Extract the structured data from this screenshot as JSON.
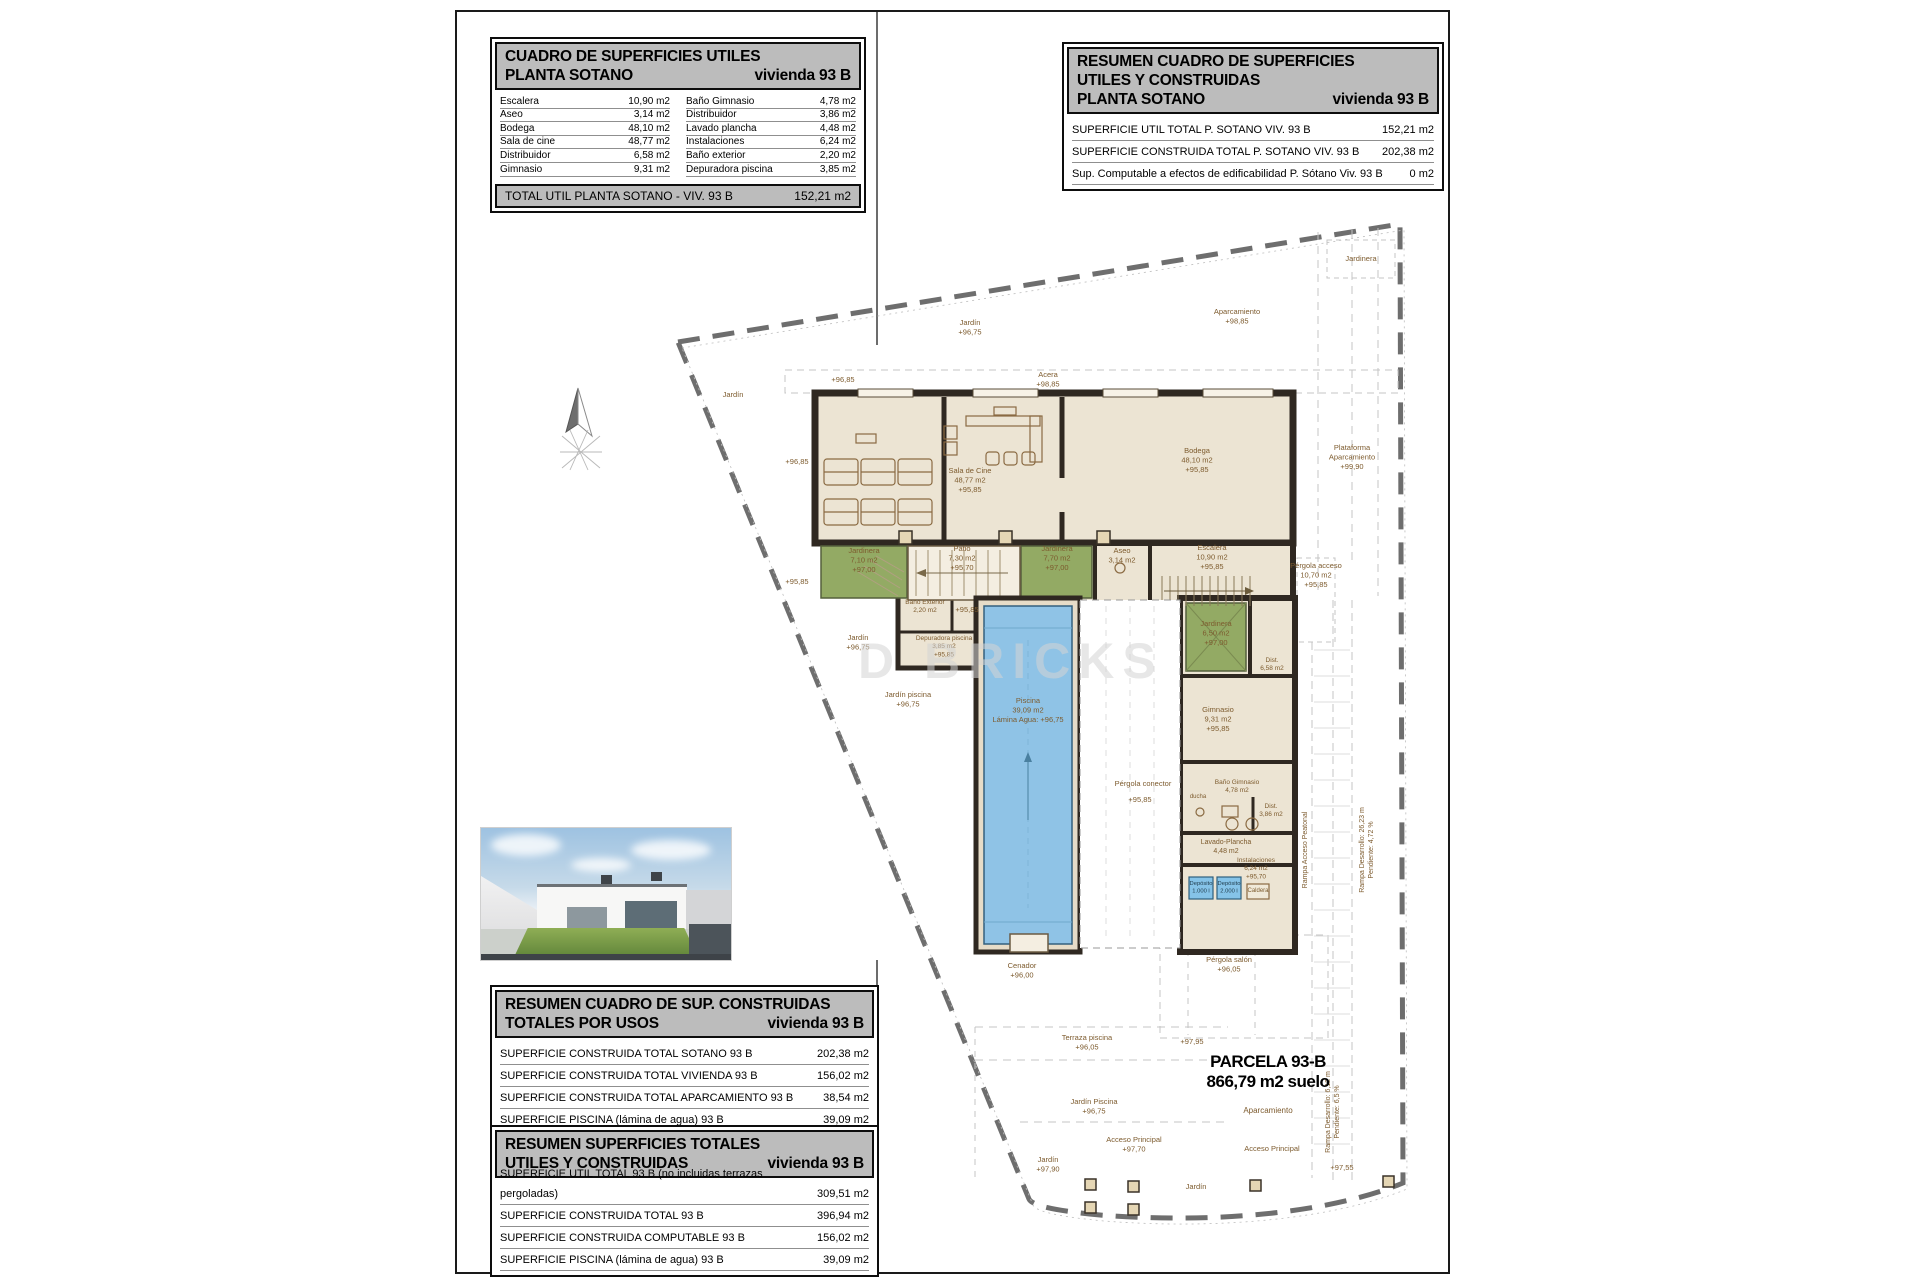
{
  "tables": {
    "cuadro_utiles": {
      "title_line1": "CUADRO DE SUPERFICIES UTILES",
      "title_line2": "PLANTA SOTANO",
      "title_vivienda": "vivienda 93 B",
      "rows_left": [
        {
          "label": "Escalera",
          "value": "10,90 m2"
        },
        {
          "label": "Aseo",
          "value": "3,14 m2"
        },
        {
          "label": "Bodega",
          "value": "48,10 m2"
        },
        {
          "label": "Sala de cine",
          "value": "48,77 m2"
        },
        {
          "label": "Distribuidor",
          "value": "6,58 m2"
        },
        {
          "label": "Gimnasio",
          "value": "9,31 m2"
        }
      ],
      "rows_right": [
        {
          "label": "Baño Gimnasio",
          "value": "4,78 m2"
        },
        {
          "label": "Distribuidor",
          "value": "3,86 m2"
        },
        {
          "label": "Lavado plancha",
          "value": "4,48 m2"
        },
        {
          "label": "Instalaciones",
          "value": "6,24 m2"
        },
        {
          "label": "Baño exterior",
          "value": "2,20 m2"
        },
        {
          "label": "Depuradora piscina",
          "value": "3,85 m2"
        }
      ],
      "total_label": "TOTAL UTIL PLANTA SOTANO -  VIV. 93 B",
      "total_value": "152,21 m2"
    },
    "resumen_sotano": {
      "title_line1": "RESUMEN CUADRO DE SUPERFICIES",
      "title_line2": "UTILES Y CONSTRUIDAS",
      "title_line3": "PLANTA SOTANO",
      "title_vivienda": "vivienda 93 B",
      "rows": [
        {
          "label": "SUPERFICIE UTIL TOTAL P. SOTANO VIV. 93 B",
          "value": "152,21 m2"
        },
        {
          "label": "SUPERFICIE CONSTRUIDA TOTAL P. SOTANO VIV. 93 B",
          "value": "202,38 m2"
        },
        {
          "label": "Sup. Computable a efectos de edificabilidad P. Sótano Viv. 93 B",
          "value": "0 m2"
        }
      ]
    },
    "construidas_usos": {
      "title_line1": "RESUMEN CUADRO DE SUP. CONSTRUIDAS",
      "title_line2": "TOTALES POR USOS",
      "title_vivienda": "vivienda 93 B",
      "rows": [
        {
          "label": "SUPERFICIE CONSTRUIDA TOTAL  SOTANO  93 B",
          "value": "202,38 m2"
        },
        {
          "label": "SUPERFICIE CONSTRUIDA TOTAL VIVIENDA 93 B",
          "value": "156,02 m2"
        },
        {
          "label": "SUPERFICIE CONSTRUIDA TOTAL APARCAMIENTO  93 B",
          "value": "38,54 m2"
        },
        {
          "label": "SUPERFICIE PISCINA (lámina de agua)  93 B",
          "value": "39,09 m2"
        }
      ]
    },
    "superficies_totales": {
      "title_line1": "RESUMEN SUPERFICIES TOTALES",
      "title_line2": "UTILES Y CONSTRUIDAS",
      "title_vivienda": "vivienda 93 B",
      "rows": [
        {
          "label": "SUPERFICIE UTIL TOTAL   93 B (no incluidas terrazas pergoladas)",
          "value": "309,51 m2"
        },
        {
          "label": "SUPERFICIE CONSTRUIDA TOTAL  93 B",
          "value": "396,94 m2"
        },
        {
          "label": "SUPERFICIE CONSTRUIDA COMPUTABLE  93 B",
          "value": "156,02 m2"
        },
        {
          "label": "SUPERFICIE PISCINA (lámina de agua)  93 B",
          "value": "39,09 m2"
        }
      ]
    }
  },
  "parcela": {
    "name": "PARCELA  93-B",
    "area": "866,79 m2 suelo",
    "sub": "Aparcamiento"
  },
  "watermark": "D BRICKS",
  "plan": {
    "labels": [
      {
        "l": [
          "Jardín",
          "+96,75"
        ],
        "x": 970,
        "y": 325
      },
      {
        "l": [
          "Acera",
          "+98,85"
        ],
        "x": 1048,
        "y": 377
      },
      {
        "l": [
          "+96,85"
        ],
        "x": 843,
        "y": 382
      },
      {
        "l": [
          "Jardín"
        ],
        "x": 733,
        "y": 397
      },
      {
        "l": [
          "+96,85"
        ],
        "x": 797,
        "y": 464
      },
      {
        "l": [
          "+95,85"
        ],
        "x": 797,
        "y": 584
      },
      {
        "l": [
          "Aparcamiento",
          "+98,85"
        ],
        "x": 1237,
        "y": 314
      },
      {
        "l": [
          "Jardinera"
        ],
        "x": 1361,
        "y": 261
      },
      {
        "l": [
          "Plataforma",
          "Aparcamiento",
          "+99,90"
        ],
        "x": 1352,
        "y": 450
      },
      {
        "l": [
          "Sala de Cine",
          "48,77 m2",
          "+95,85"
        ],
        "x": 970,
        "y": 473
      },
      {
        "l": [
          "Bodega",
          "48,10 m2",
          "+95,85"
        ],
        "x": 1197,
        "y": 453
      },
      {
        "l": [
          "Escalera",
          "10,90 m2",
          "+95,85"
        ],
        "x": 1212,
        "y": 550
      },
      {
        "l": [
          "Aseo",
          "3,14 m2"
        ],
        "x": 1122,
        "y": 553
      },
      {
        "l": [
          "Jardinera",
          "7,10 m2",
          "+97,00"
        ],
        "x": 864,
        "y": 553
      },
      {
        "l": [
          "Patio",
          "7,30 m2",
          "+95,70"
        ],
        "x": 962,
        "y": 551
      },
      {
        "l": [
          "Jardinera",
          "7,70 m2",
          "+97,00"
        ],
        "x": 1057,
        "y": 551
      },
      {
        "l": [
          "Pérgola acceso",
          "10,70 m2",
          "+95,85"
        ],
        "x": 1316,
        "y": 568
      },
      {
        "l": [
          "+95,85"
        ],
        "x": 967,
        "y": 612
      },
      {
        "l": [
          "Baño Exterior",
          "2,20 m2"
        ],
        "x": 925,
        "y": 604,
        "size": 6.5
      },
      {
        "l": [
          "Depuradora piscina",
          "3,85 m2",
          "+95,85"
        ],
        "x": 944,
        "y": 640,
        "size": 6.5
      },
      {
        "l": [
          "Jardín",
          "+96,75"
        ],
        "x": 858,
        "y": 640
      },
      {
        "l": [
          "Jardín piscina",
          "+96,75"
        ],
        "x": 908,
        "y": 697
      },
      {
        "l": [
          "Jardinera",
          "6,50 m2",
          "+97,00"
        ],
        "x": 1216,
        "y": 626
      },
      {
        "l": [
          "Dist.",
          "6,58 m2"
        ],
        "x": 1272,
        "y": 662,
        "size": 6.5
      },
      {
        "l": [
          "Gimnasio",
          "9,31 m2",
          "+95,85"
        ],
        "x": 1218,
        "y": 712
      },
      {
        "l": [
          "Pérgola conector"
        ],
        "x": 1143,
        "y": 786
      },
      {
        "l": [
          "+95,85"
        ],
        "x": 1140,
        "y": 802
      },
      {
        "l": [
          "ducha"
        ],
        "x": 1198,
        "y": 798,
        "size": 6
      },
      {
        "l": [
          "Baño Gimnasio",
          "4,78 m2"
        ],
        "x": 1237,
        "y": 784,
        "size": 6.5
      },
      {
        "l": [
          "Dist.",
          "3,86 m2"
        ],
        "x": 1271,
        "y": 808,
        "size": 6.5
      },
      {
        "l": [
          "Lavado-Plancha",
          "4,48 m2"
        ],
        "x": 1226,
        "y": 844,
        "size": 7
      },
      {
        "l": [
          "Instalaciones",
          "6,24 m2",
          "+95,70"
        ],
        "x": 1256,
        "y": 862,
        "size": 6.5
      },
      {
        "l": [
          "Depósito",
          "1.000 l"
        ],
        "x": 1201,
        "y": 885,
        "size": 5.8,
        "color": "#1e3a4a"
      },
      {
        "l": [
          "Depósito",
          "2.000 l"
        ],
        "x": 1229,
        "y": 885,
        "size": 5.8,
        "color": "#1e3a4a"
      },
      {
        "l": [
          "Caldera"
        ],
        "x": 1258,
        "y": 892,
        "size": 6
      },
      {
        "l": [
          "Piscina",
          "39,09 m2",
          "Lámina Agua: +96,75"
        ],
        "x": 1028,
        "y": 703
      },
      {
        "l": [
          "Cenador",
          "+96,00"
        ],
        "x": 1022,
        "y": 968
      },
      {
        "l": [
          "Pérgola salón",
          "+96,05"
        ],
        "x": 1229,
        "y": 962
      },
      {
        "l": [
          "Terraza piscina",
          "+96,05"
        ],
        "x": 1087,
        "y": 1040
      },
      {
        "l": [
          "+97,95"
        ],
        "x": 1192,
        "y": 1044
      },
      {
        "l": [
          "Jardín Piscina",
          "+96,75"
        ],
        "x": 1094,
        "y": 1104
      },
      {
        "l": [
          "Acceso Principal",
          "+97,70"
        ],
        "x": 1134,
        "y": 1142
      },
      {
        "l": [
          "Acceso Principal"
        ],
        "x": 1272,
        "y": 1151
      },
      {
        "l": [
          "Jardín",
          "+97,90"
        ],
        "x": 1048,
        "y": 1162
      },
      {
        "l": [
          "Jardín"
        ],
        "x": 1196,
        "y": 1189
      },
      {
        "l": [
          "+97,55"
        ],
        "x": 1342,
        "y": 1170
      },
      {
        "l": [
          "Rampa Acceso Peatonal"
        ],
        "x": 1307,
        "y": 850,
        "rot": -90,
        "size": 7
      },
      {
        "l": [
          "Rampa Desarrollo: 26,23 m",
          "Pendiente: 4,72 %"
        ],
        "x": 1364,
        "y": 850,
        "rot": -90,
        "size": 7
      },
      {
        "l": [
          "Rampa Desarrollo: 6,12 m",
          "Pendiente: 6,5 %"
        ],
        "x": 1330,
        "y": 1112,
        "rot": -90,
        "size": 7
      }
    ]
  }
}
